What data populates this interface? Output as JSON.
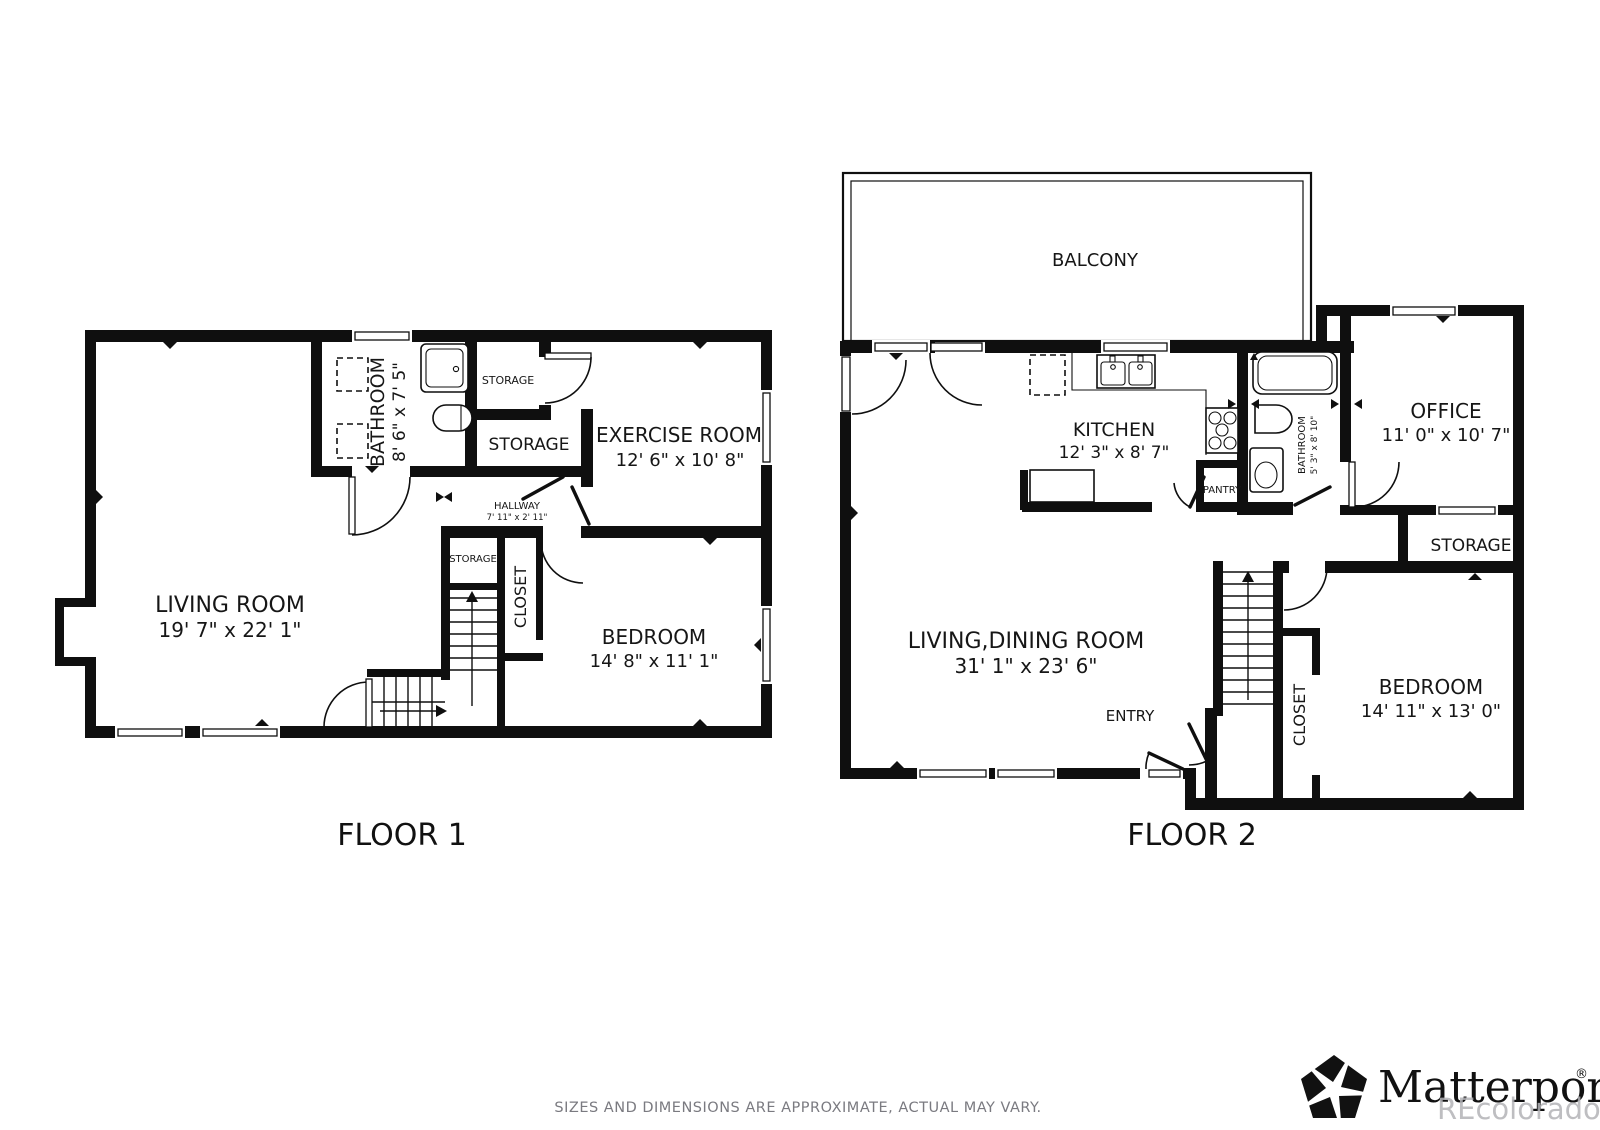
{
  "floor1": {
    "title": "FLOOR 1",
    "rooms": {
      "bathroom": {
        "name": "BATHROOM",
        "dims": "8' 6\" x 7' 5\""
      },
      "storage_top": {
        "name": "STORAGE"
      },
      "storage_mid": {
        "name": "STORAGE"
      },
      "exercise": {
        "name": "EXERCISE ROOM",
        "dims": "12' 6\" x 10' 8\""
      },
      "hallway": {
        "name": "HALLWAY",
        "dims": "7' 11\" x 2' 11\""
      },
      "storage_small": {
        "name": "STORAGE"
      },
      "closet": {
        "name": "CLOSET"
      },
      "living": {
        "name": "LIVING ROOM",
        "dims": "19' 7\" x 22' 1\""
      },
      "bedroom": {
        "name": "BEDROOM",
        "dims": "14' 8\" x 11' 1\""
      }
    }
  },
  "floor2": {
    "title": "FLOOR 2",
    "rooms": {
      "balcony": {
        "name": "BALCONY"
      },
      "kitchen": {
        "name": "KITCHEN",
        "dims": "12' 3\" x 8' 7\""
      },
      "pantry": {
        "name": "PANTRY"
      },
      "bathroom": {
        "name": "BATHROOM",
        "dims": "5' 3\" x 8' 10\""
      },
      "office": {
        "name": "OFFICE",
        "dims": "11' 0\" x 10' 7\""
      },
      "storage": {
        "name": "STORAGE"
      },
      "living_dining": {
        "name": "LIVING,DINING ROOM",
        "dims": "31' 1\" x 23' 6\""
      },
      "entry": {
        "name": "ENTRY"
      },
      "closet": {
        "name": "CLOSET"
      },
      "bedroom": {
        "name": "BEDROOM",
        "dims": "14' 11\" x 13' 0\""
      }
    }
  },
  "footer": {
    "disclaimer": "SIZES AND DIMENSIONS ARE APPROXIMATE, ACTUAL MAY VARY."
  },
  "branding": {
    "logo_text": "Matterport",
    "registered": "®",
    "watermark": "REcolorado"
  },
  "colors": {
    "wall": "#0f0f0f",
    "background": "#ffffff",
    "disclaimer_text": "#7a7a80",
    "watermark_text": "#b3b3b7"
  }
}
